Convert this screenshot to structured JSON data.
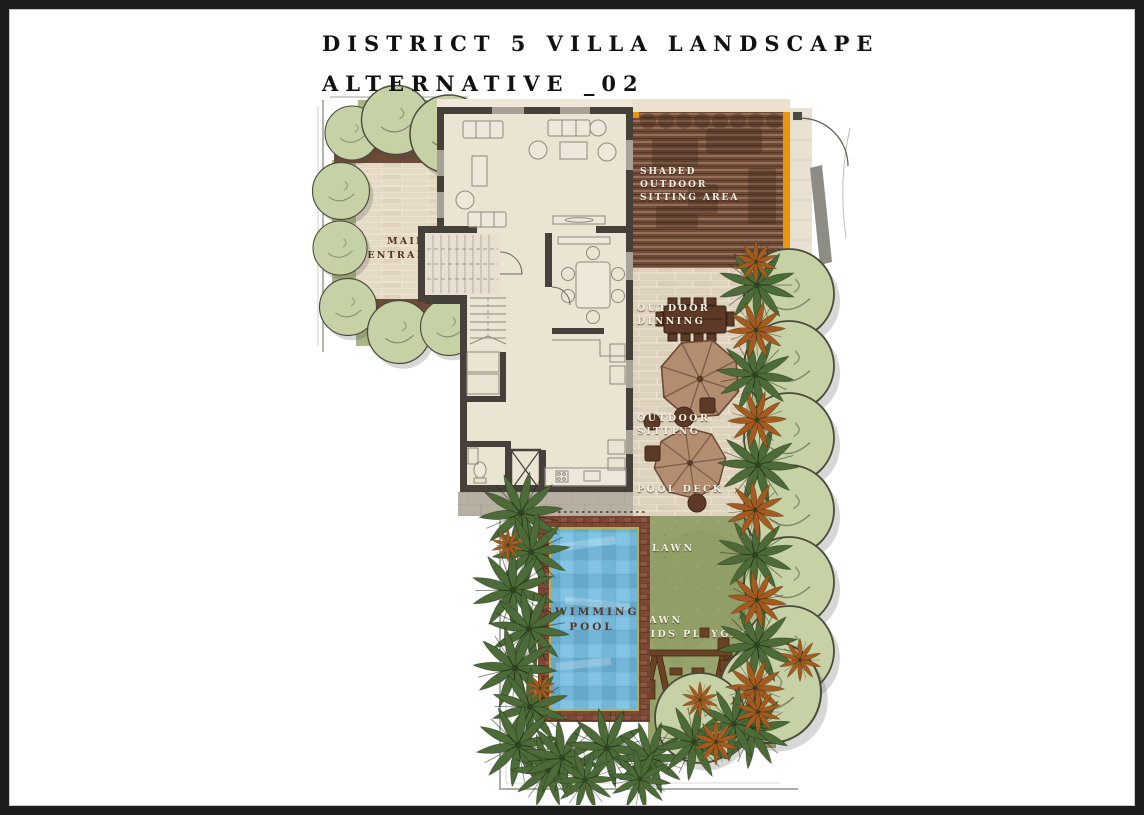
{
  "title": {
    "line1": "DISTRICT 5 VILLA LANDSCAPE",
    "line2": "ALTERNATIVE _02"
  },
  "labels": {
    "main_entrance": [
      "MAIN",
      "ENTRANCE"
    ],
    "shaded_sitting": [
      "SHADED",
      "OUTDOOR",
      "SITTING AREA"
    ],
    "outdoor_dinning": [
      "OUTDOOR",
      "DINNING"
    ],
    "outdoor_sitting": [
      "OUTDOOR",
      "SITTING"
    ],
    "pool_deck": "POOL DECK",
    "lawn": "LAWN",
    "kids_playground": [
      "LAWN",
      "KIDS PLAYGROUND"
    ],
    "swimming_pool": [
      "SWIMMING",
      "POOL"
    ]
  },
  "colors": {
    "frame_black": "#1D1D1D",
    "wall_dark": "#46403A",
    "floor_beige": "#EAE4D3",
    "stone_patio": "#DDD2BD",
    "deck_wood": "#6E4A37",
    "deck_accent_orange": "#E8940E",
    "planter_green": "#A9B585",
    "tree_sage": "#C6D1A6",
    "palm_green": "#4D6B38",
    "palm_orange": "#A65A20",
    "lawn_green": "#96A26B",
    "pool_blue": "#74B6D8",
    "pool_border_terracotta": "#7D4936",
    "label_white": "#F3EFE4",
    "label_dark": "#4F3626"
  }
}
